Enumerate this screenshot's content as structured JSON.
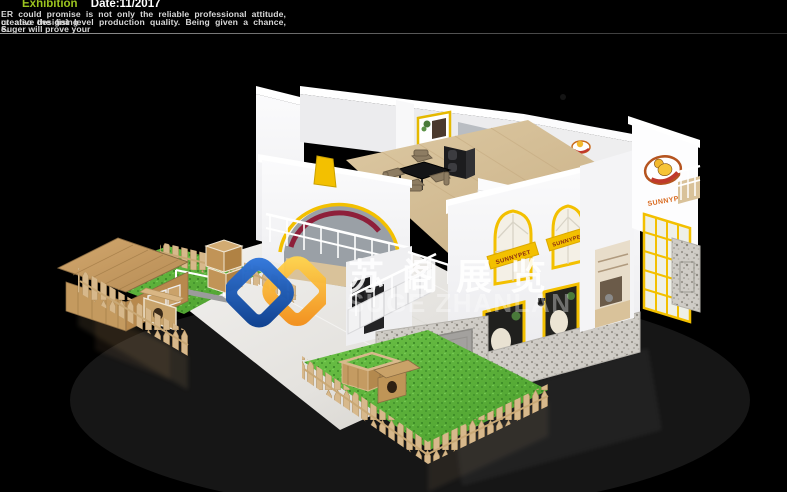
{
  "header": {
    "section_label": "Exhibition",
    "date_label": "Date:11/2017",
    "paragraph_line1": "ER could promise is not only the reliable professional attitude, creative designing",
    "paragraph_line2": "ut also the fist level production quality. Being given a chance, Suger will prove your",
    "paragraph_line3": "e."
  },
  "watermark": {
    "logo_name": "suge-zhanlan-logo",
    "chinese_name": "苏阁展览",
    "latin_name": "SUGE ZHANLAN"
  },
  "booth": {
    "brand": "SUNNYPET",
    "tower_wordmark": "SUNNYPET",
    "window_banner_left": "SUNNYPET",
    "window_banner_right": "SUNNYPET"
  },
  "colors": {
    "background": "#000000",
    "accent_yellow": "#f3c000",
    "brand_orange": "#d96a1f",
    "header_green": "#9cc41f",
    "maroon_arc": "#8e1f3a",
    "grass_green": "#57b63a",
    "fence_wood": "#d7b88b",
    "stone_gray": "#cfccc6",
    "logo_blue": "#1e5bb0",
    "logo_gold": "#f7a81b"
  }
}
